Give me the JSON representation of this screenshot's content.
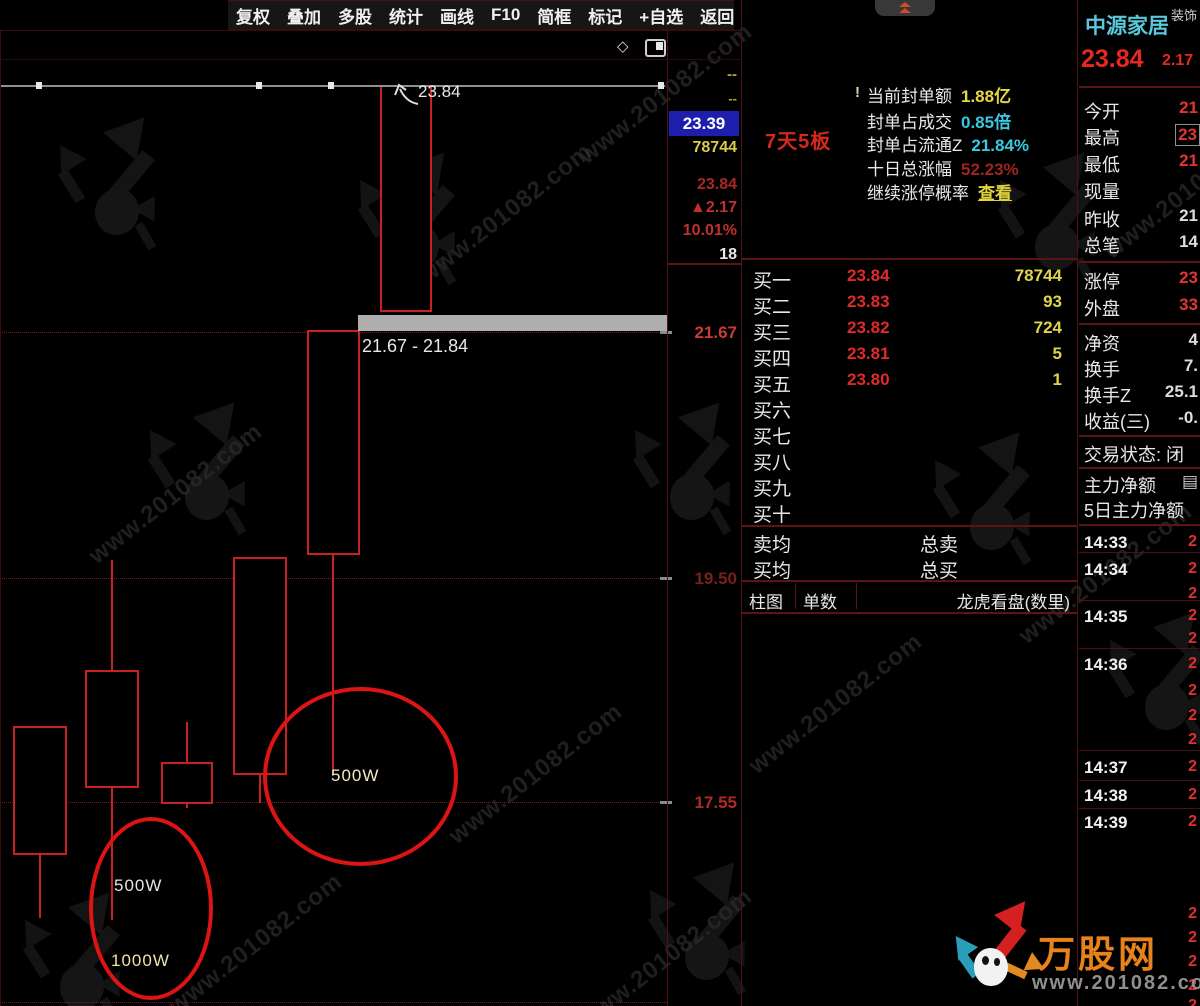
{
  "toolbar": {
    "items": [
      "复权",
      "叠加",
      "多股",
      "统计",
      "画线",
      "F10",
      "简框",
      "标记",
      "+自选",
      "返回"
    ]
  },
  "subtoolbar": {
    "diamond": "◇"
  },
  "chart": {
    "annotations": {
      "price_label": "23.84",
      "zone_label": "21.67 - 21.84",
      "circle_big_label": "500W",
      "circle_small_label_1": "500W",
      "circle_small_label_2": "1000W"
    }
  },
  "chart_data": {
    "type": "candlestick",
    "title": "",
    "y_axis": {
      "labels": [
        {
          "text": "21.67",
          "y": 332,
          "color": "#cb3b35"
        },
        {
          "text": "19.50",
          "y": 578,
          "color": "#77201c"
        },
        {
          "text": "17.55",
          "y": 802,
          "color": "#b02a24"
        }
      ],
      "top_price": 23.84,
      "top_y": 85,
      "px_per_unit": 113.8
    },
    "gridlines_y": [
      332,
      578,
      802,
      1002
    ],
    "candles": [
      {
        "x_center": 40,
        "body_left": 13,
        "body_right": 67,
        "body_top_y": 726,
        "body_bottom_y": 855,
        "wick_top_y": 726,
        "wick_bottom_y": 918,
        "est_open": 17.08,
        "est_close": 18.21,
        "est_high": 18.21,
        "est_low": 16.52
      },
      {
        "x_center": 112,
        "body_left": 85,
        "body_right": 139,
        "body_top_y": 670,
        "body_bottom_y": 788,
        "wick_top_y": 560,
        "wick_bottom_y": 920,
        "est_open": 17.66,
        "est_close": 18.7,
        "est_high": 19.66,
        "est_low": 16.5
      },
      {
        "x_center": 187,
        "body_left": 161,
        "body_right": 213,
        "body_top_y": 762,
        "body_bottom_y": 804,
        "wick_top_y": 722,
        "wick_bottom_y": 808,
        "est_open": 17.52,
        "est_close": 17.89,
        "est_high": 18.24,
        "est_low": 17.49
      },
      {
        "x_center": 260,
        "body_left": 233,
        "body_right": 287,
        "body_top_y": 557,
        "body_bottom_y": 775,
        "wick_top_y": 557,
        "wick_bottom_y": 803,
        "est_open": 17.78,
        "est_close": 19.69,
        "est_high": 19.69,
        "est_low": 17.54
      },
      {
        "x_center": 333,
        "body_left": 307,
        "body_right": 360,
        "body_top_y": 330,
        "body_bottom_y": 555,
        "wick_top_y": 330,
        "wick_bottom_y": 775,
        "est_open": 19.71,
        "est_close": 21.69,
        "est_high": 21.69,
        "est_low": 17.78
      },
      {
        "x_center": 406,
        "body_left": 380,
        "body_right": 432,
        "body_top_y": 85,
        "body_bottom_y": 312,
        "wick_top_y": 85,
        "wick_bottom_y": 312,
        "est_open": 21.84,
        "est_close": 23.84,
        "est_high": 23.84,
        "est_low": 21.84
      }
    ],
    "drawn_line": {
      "y": 85,
      "x1": 0,
      "x2": 665,
      "handles_x": [
        36,
        256,
        328,
        658
      ]
    },
    "zone_bar": {
      "x1": 358,
      "x2": 670,
      "y1": 315,
      "y2": 331
    }
  },
  "strip": {
    "dash1": "--",
    "dash2": "--",
    "highlight_price": "23.39",
    "volume": "78744",
    "price": "23.84",
    "change": "▲2.17",
    "change_pct": "10.01%",
    "count": "18"
  },
  "info_panel": {
    "exclaim": "!",
    "badge": "7天5板",
    "rows": [
      {
        "label": "当前封单额",
        "value": "1.88亿",
        "color": "#e8d83f",
        "underline": false,
        "y": 82
      },
      {
        "label": "封单占成交",
        "value": "0.85倍",
        "color": "#39c8e0",
        "underline": false,
        "y": 108
      },
      {
        "label": "封单占流通Z",
        "value": "21.84%",
        "color": "#39c8e0",
        "underline": false,
        "y": 131
      },
      {
        "label": "十日总涨幅",
        "value": "52.23%",
        "color": "#a02420",
        "underline": false,
        "y": 155
      },
      {
        "label": "继续涨停概率",
        "value": "查看",
        "color": "#e0d43a",
        "underline": true,
        "y": 179
      }
    ]
  },
  "order_book": {
    "rows": [
      {
        "label": "买一",
        "price": "23.84",
        "vol": "78744"
      },
      {
        "label": "买二",
        "price": "23.83",
        "vol": "93"
      },
      {
        "label": "买三",
        "price": "23.82",
        "vol": "724"
      },
      {
        "label": "买四",
        "price": "23.81",
        "vol": "5"
      },
      {
        "label": "买五",
        "price": "23.80",
        "vol": "1"
      },
      {
        "label": "买六",
        "price": "",
        "vol": ""
      },
      {
        "label": "买七",
        "price": "",
        "vol": ""
      },
      {
        "label": "买八",
        "price": "",
        "vol": ""
      },
      {
        "label": "买九",
        "price": "",
        "vol": ""
      },
      {
        "label": "买十",
        "price": "",
        "vol": ""
      }
    ],
    "avg_rows": [
      {
        "left": "卖均",
        "right": "总卖"
      },
      {
        "left": "买均",
        "right": "总买"
      }
    ],
    "tabs": [
      "柱图",
      "单数"
    ],
    "tab_right": "龙虎看盘(数里)"
  },
  "quote_panel": {
    "name": "中源家居",
    "name_suffix": "装饰",
    "price": "23.84",
    "change": "2.17",
    "stat_rows": [
      {
        "label": "今开",
        "value": "21",
        "color": "#e33434",
        "boxed": false,
        "y": 98
      },
      {
        "label": "最高",
        "value": "23",
        "color": "#e33434",
        "boxed": true,
        "y": 124
      },
      {
        "label": "最低",
        "value": "21",
        "color": "#e33434",
        "boxed": false,
        "y": 151
      },
      {
        "label": "现量",
        "value": "",
        "color": "#dddddd",
        "boxed": false,
        "y": 178
      },
      {
        "label": "昨收",
        "value": "21",
        "color": "#dddddd",
        "boxed": false,
        "y": 206
      },
      {
        "label": "总笔",
        "value": "14",
        "color": "#dddddd",
        "boxed": false,
        "y": 232
      },
      {
        "label": "涨停",
        "value": "23",
        "color": "#e33434",
        "boxed": false,
        "y": 268
      },
      {
        "label": "外盘",
        "value": "33",
        "color": "#e33434",
        "boxed": false,
        "y": 295
      },
      {
        "label": "净资",
        "value": "4",
        "color": "#dddddd",
        "boxed": false,
        "y": 330
      },
      {
        "label": "换手",
        "value": "7.",
        "color": "#dddddd",
        "boxed": false,
        "y": 356
      },
      {
        "label": "换手Z",
        "value": "25.1",
        "color": "#dddddd",
        "boxed": false,
        "y": 382
      },
      {
        "label": "收益(三)",
        "value": "-0.",
        "color": "#dddddd",
        "boxed": false,
        "y": 408
      },
      {
        "label": "交易状态: 闭",
        "value": "",
        "color": "#dddddd",
        "boxed": false,
        "y": 441
      },
      {
        "label": "主力净额",
        "value": "▤",
        "color": "#cccccc",
        "boxed": false,
        "y": 472
      },
      {
        "label": "5日主力净额",
        "value": "",
        "color": "#dddddd",
        "boxed": false,
        "y": 497
      }
    ],
    "dividers_y": [
      86,
      261,
      323,
      435,
      467,
      524
    ],
    "ticks": [
      {
        "time": "14:33",
        "value": "2",
        "y": 533
      },
      {
        "time": "14:34",
        "value": "2",
        "y": 560
      },
      {
        "time": "",
        "value": "2",
        "y": 585
      },
      {
        "time": "14:35",
        "value": "2",
        "y": 607
      },
      {
        "time": "",
        "value": "2",
        "y": 630
      },
      {
        "time": "14:36",
        "value": "2",
        "y": 655
      },
      {
        "time": "",
        "value": "2",
        "y": 682
      },
      {
        "time": "",
        "value": "2",
        "y": 707
      },
      {
        "time": "",
        "value": "2",
        "y": 731
      },
      {
        "time": "14:37",
        "value": "2",
        "y": 758
      },
      {
        "time": "14:38",
        "value": "2",
        "y": 786
      },
      {
        "time": "14:39",
        "value": "2",
        "y": 813
      },
      {
        "time": "",
        "value": "2",
        "y": 905
      },
      {
        "time": "",
        "value": "2",
        "y": 929
      },
      {
        "time": "",
        "value": "2",
        "y": 953
      },
      {
        "time": "",
        "value": "2",
        "y": 977
      },
      {
        "time": "",
        "value": "2",
        "y": 997
      }
    ],
    "tick_separators_y": [
      552,
      600,
      648,
      750,
      780,
      808
    ]
  },
  "site_logo": {
    "title": "万股网",
    "url": "www.201082.com"
  },
  "watermark": {
    "text": "www.201082.com",
    "text_positions": [
      {
        "x": 400,
        "y": 200
      },
      {
        "x": 560,
        "y": 80
      },
      {
        "x": 70,
        "y": 480
      },
      {
        "x": 430,
        "y": 760
      },
      {
        "x": 150,
        "y": 930
      },
      {
        "x": 1000,
        "y": 560
      },
      {
        "x": 1085,
        "y": 175
      },
      {
        "x": 730,
        "y": 690
      },
      {
        "x": 560,
        "y": 945
      }
    ],
    "logo_positions": [
      {
        "x": 40,
        "y": 105
      },
      {
        "x": 340,
        "y": 140
      },
      {
        "x": 130,
        "y": 390
      },
      {
        "x": 615,
        "y": 390
      },
      {
        "x": 980,
        "y": 140
      },
      {
        "x": 1090,
        "y": 600
      },
      {
        "x": 5,
        "y": 880
      },
      {
        "x": 630,
        "y": 850
      },
      {
        "x": 915,
        "y": 420
      }
    ]
  }
}
